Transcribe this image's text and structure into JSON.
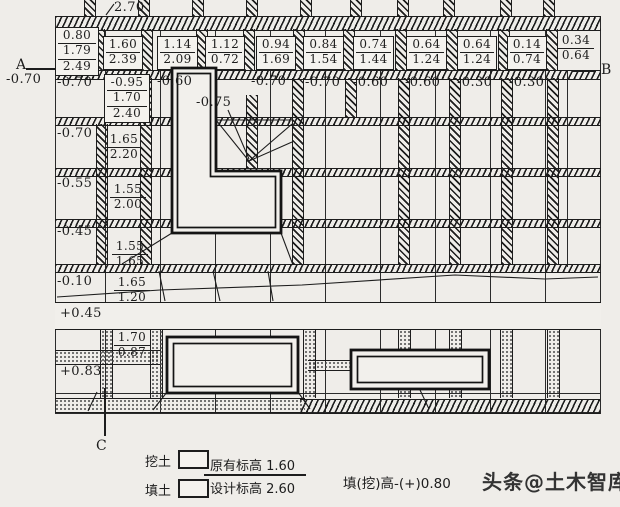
{
  "colors": {
    "paper": "#efede9",
    "ink": "#1d1d1d"
  },
  "markers": {
    "a": "A",
    "b": "B",
    "c": "C",
    "a_elev": "-0.70",
    "top_elev": "2.70"
  },
  "top_boxes": [
    [
      "0.80",
      "1.79",
      "2.49"
    ],
    [
      "1.60",
      "2.39"
    ],
    [
      "1.14",
      "2.09"
    ],
    [
      "1.12",
      "0.72"
    ],
    [
      "0.94",
      "1.69"
    ],
    [
      "0.84",
      "1.54"
    ],
    [
      "0.74",
      "1.44"
    ],
    [
      "0.64",
      "1.24"
    ],
    [
      "0.64",
      "1.24"
    ],
    [
      "0.14",
      "0.74"
    ],
    [
      "0.34",
      "0.64"
    ]
  ],
  "row2_box": [
    "-0.95",
    "1.70",
    "2.40"
  ],
  "row2_labels": [
    "-0.70",
    "-0.60",
    "-0.75",
    "-0.70",
    "-0.70",
    "-0.60",
    "-0.60",
    "-0.30",
    "-0.30"
  ],
  "left_labels": [
    "-0.70",
    "-0.55",
    "-0.45",
    "-0.10",
    "+0.45",
    "+0.83"
  ],
  "side_boxes": [
    [
      "1.65",
      "2.20"
    ],
    [
      "1.55",
      "2.00"
    ],
    [
      "1.55",
      "1.65"
    ],
    [
      "1.65",
      "1.20"
    ],
    [
      "1.70",
      "0.87"
    ]
  ],
  "legend": {
    "cut_label": "挖土",
    "fill_label": "填土",
    "original_elevation": "原有标高 1.60",
    "design_elevation": "设计标高 2.60",
    "formula": "填(挖)高-(+)0.80"
  },
  "watermark": "头条@土木智库"
}
